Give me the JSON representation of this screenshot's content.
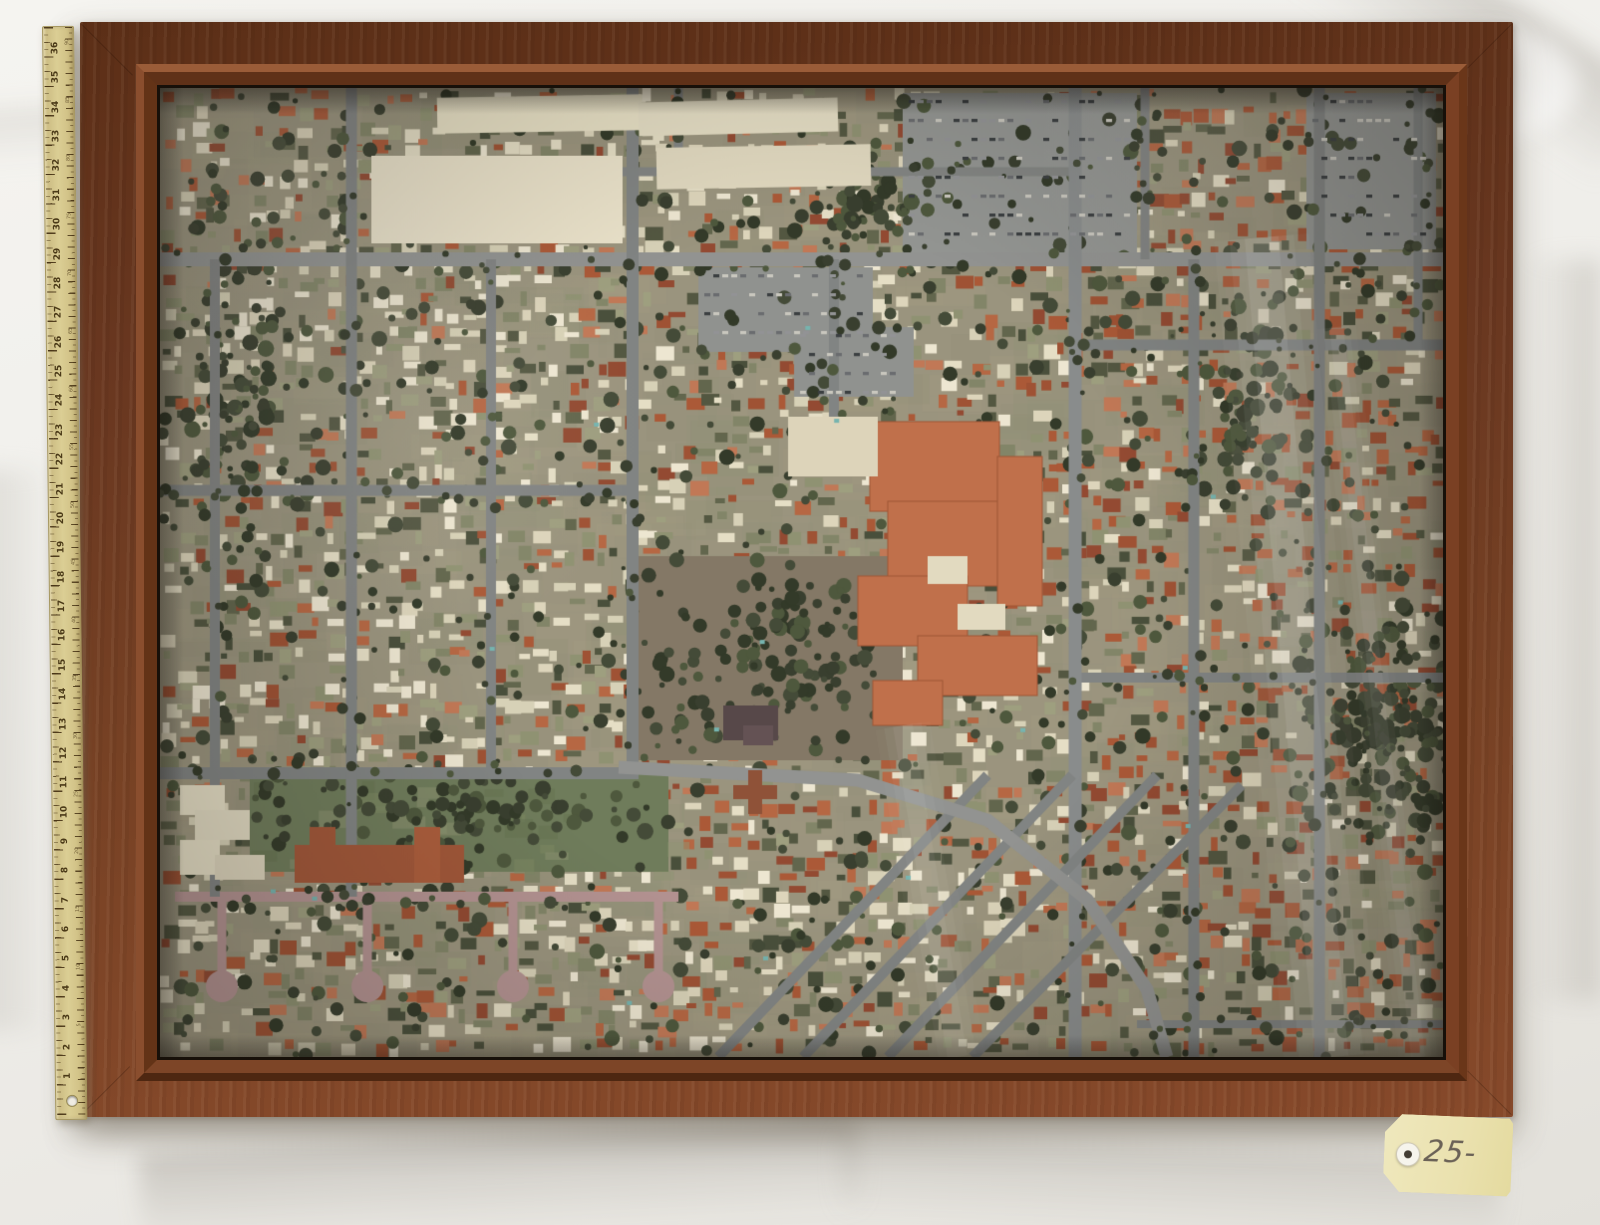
{
  "scene": {
    "tag": {
      "label": "25-234",
      "color": "#eae1ae"
    },
    "ruler": {
      "inch_numbers": [
        36,
        35,
        34,
        33,
        32,
        31,
        30,
        29,
        28,
        27,
        26,
        25,
        24,
        23,
        22,
        21,
        20,
        19,
        18,
        17,
        16,
        15,
        14,
        13,
        12,
        11,
        10,
        9,
        8,
        7,
        6,
        5,
        4,
        3,
        2,
        1
      ],
      "cm_numbers": [
        90,
        85,
        80,
        75,
        70,
        65,
        60,
        55,
        50,
        45,
        40,
        35,
        30,
        25,
        20,
        15,
        10,
        5
      ],
      "inch_spacing": 29.37,
      "cm_spacing": 11.56
    },
    "colors": {
      "cloth": "#f0efeb",
      "frame_dark": "#5c2f17",
      "frame_light": "#86492a",
      "ruler": "#d5c58b",
      "tag": "#eae1ae"
    }
  },
  "aerial": {
    "seed": 77,
    "width": 1287,
    "height": 973,
    "base": "#96917b",
    "mottle": [
      "#a29a80",
      "#8d8872",
      "#9b957e",
      "#878a70",
      "#a79f86"
    ],
    "palette": {
      "red": [
        "#a8512f",
        "#b4603c",
        "#8e4129",
        "#c07350",
        "#9b4a2c"
      ],
      "cream": [
        "#e7e0c8",
        "#ded7bd",
        "#efe9d4",
        "#d8d2b8"
      ],
      "olive": [
        "#8a8f6e",
        "#9a9c7c",
        "#7c8163"
      ],
      "dark": [
        "#4a4f3a",
        "#5a5f46",
        "#3f4633"
      ]
    },
    "regions": [
      {
        "x0": 915,
        "x1": 1287,
        "y0": 0,
        "y1": 973,
        "w": {
          "red": 0.46,
          "cream": 0.2,
          "olive": 0.14,
          "dark": 0.2
        }
      },
      {
        "x0": 0,
        "x1": 915,
        "y0": 0,
        "y1": 172,
        "w": {
          "cream": 0.38,
          "red": 0.28,
          "olive": 0.18,
          "dark": 0.16
        }
      },
      {
        "x0": 0,
        "x1": 480,
        "y0": 172,
        "y1": 973,
        "w": {
          "cream": 0.4,
          "red": 0.22,
          "olive": 0.22,
          "dark": 0.16
        }
      },
      {
        "x0": 480,
        "x1": 915,
        "y0": 172,
        "y1": 973,
        "w": {
          "red": 0.32,
          "cream": 0.3,
          "olive": 0.2,
          "dark": 0.18
        }
      }
    ],
    "road_minor": "#7b7f80",
    "road_major": "#8d9090",
    "roads_h": [
      {
        "y": 172,
        "x0": 0,
        "x1": 1287,
        "w": 14,
        "c": "#8d9090"
      },
      {
        "y": 84,
        "x0": 460,
        "x1": 920,
        "w": 9,
        "c": "#7d8180"
      },
      {
        "y": 404,
        "x0": 0,
        "x1": 480,
        "w": 11,
        "c": "#7b7f80"
      },
      {
        "y": 688,
        "x0": 0,
        "x1": 480,
        "w": 12,
        "c": "#7b7f80"
      },
      {
        "y": 258,
        "x0": 915,
        "x1": 1287,
        "w": 11,
        "c": "#7b7f80"
      },
      {
        "y": 592,
        "x0": 915,
        "x1": 1287,
        "w": 10,
        "c": "#7b7f80"
      },
      {
        "y": 812,
        "x0": 15,
        "x1": 520,
        "w": 10,
        "c": "#b18f90"
      },
      {
        "y": 940,
        "x0": 980,
        "x1": 1287,
        "w": 8,
        "c": "#7b7f80"
      }
    ],
    "roads_v": [
      {
        "x": 55,
        "y0": 172,
        "y1": 812,
        "w": 10,
        "c": "#7b7f80"
      },
      {
        "x": 192,
        "y0": 0,
        "y1": 812,
        "w": 11,
        "c": "#7b7f80"
      },
      {
        "x": 332,
        "y0": 172,
        "y1": 688,
        "w": 10,
        "c": "#7b7f80"
      },
      {
        "x": 474,
        "y0": 0,
        "y1": 688,
        "w": 12,
        "c": "#7b7f80"
      },
      {
        "x": 520,
        "y0": 0,
        "y1": 84,
        "w": 9,
        "c": "#7b7f80"
      },
      {
        "x": 676,
        "y0": 172,
        "y1": 345,
        "w": 10,
        "c": "#7b7f80"
      },
      {
        "x": 918,
        "y0": 0,
        "y1": 973,
        "w": 13,
        "c": "#84888a"
      },
      {
        "x": 988,
        "y0": 0,
        "y1": 172,
        "w": 9,
        "c": "#7b7f80"
      },
      {
        "x": 1037,
        "y0": 172,
        "y1": 973,
        "w": 11,
        "c": "#7b7f80"
      },
      {
        "x": 1163,
        "y0": 0,
        "y1": 973,
        "w": 11,
        "c": "#7b7f80"
      },
      {
        "x": 1262,
        "y0": 0,
        "y1": 258,
        "w": 9,
        "c": "#7b7f80"
      }
    ],
    "diagonals": [
      {
        "x0": 560,
        "y0": 973,
        "x1": 830,
        "y1": 690,
        "w": 10
      },
      {
        "x0": 645,
        "y0": 973,
        "x1": 915,
        "y1": 690,
        "w": 10
      },
      {
        "x0": 730,
        "y0": 973,
        "x1": 1000,
        "y1": 690,
        "w": 10
      },
      {
        "x0": 815,
        "y0": 973,
        "x1": 1085,
        "y1": 700,
        "w": 10
      }
    ],
    "curve": {
      "pts": [
        [
          460,
          682
        ],
        [
          700,
          695
        ],
        [
          830,
          735
        ],
        [
          930,
          815
        ],
        [
          990,
          905
        ],
        [
          1010,
          973
        ]
      ],
      "w": 13
    },
    "culdesac": {
      "c": "#b18f90",
      "stems": [
        62,
        208,
        354,
        500
      ],
      "y0": 812,
      "y1": 896
    },
    "patches": [
      {
        "x": 90,
        "y": 682,
        "w": 420,
        "h": 105,
        "c": "#687755",
        "t": "park"
      },
      {
        "x": 480,
        "y": 470,
        "w": 265,
        "h": 205,
        "c": "#7e7361",
        "t": "field"
      },
      {
        "x": 540,
        "y": 180,
        "w": 175,
        "h": 85,
        "c": "#8b8e8d",
        "t": "parking"
      },
      {
        "x": 745,
        "y": 5,
        "w": 235,
        "h": 162,
        "c": "#8f9291",
        "t": "parking"
      },
      {
        "x": 1150,
        "y": 5,
        "w": 130,
        "h": 157,
        "c": "#8f9291",
        "t": "parking"
      },
      {
        "x": 636,
        "y": 240,
        "w": 120,
        "h": 70,
        "c": "#8b8e8d",
        "t": "parking"
      }
    ],
    "park_tones": [
      "#77855f",
      "#5c6b4a",
      "#8a9270"
    ],
    "hospital": {
      "c": "#bf6a44",
      "edge": "#9c4f2e",
      "rects": [
        [
          712,
          335,
          130,
          90
        ],
        [
          730,
          415,
          150,
          85
        ],
        [
          700,
          490,
          110,
          70
        ],
        [
          760,
          550,
          120,
          60
        ],
        [
          715,
          595,
          70,
          45
        ],
        [
          840,
          370,
          45,
          150
        ]
      ],
      "white": [
        [
          770,
          470,
          40,
          28
        ],
        [
          800,
          518,
          48,
          26
        ]
      ]
    },
    "buildings": [
      {
        "x": 278,
        "y": 8,
        "w": 205,
        "h": 36,
        "c": "#e9e2c8",
        "rot": -1
      },
      {
        "x": 212,
        "y": 68,
        "w": 252,
        "h": 88,
        "c": "#ece5cd",
        "rot": 0
      },
      {
        "x": 480,
        "y": 12,
        "w": 200,
        "h": 34,
        "c": "#e6dfc6",
        "rot": -1.5
      },
      {
        "x": 498,
        "y": 58,
        "w": 215,
        "h": 42,
        "c": "#e2dbc2",
        "rot": -1
      },
      {
        "x": 630,
        "y": 330,
        "w": 90,
        "h": 60,
        "c": "#ded6bc",
        "rot": 0
      },
      {
        "x": 20,
        "y": 700,
        "w": 45,
        "h": 30,
        "c": "#e8e1c9",
        "rot": 0
      },
      {
        "x": 35,
        "y": 725,
        "w": 55,
        "h": 30,
        "c": "#e4ddc5",
        "rot": 0
      },
      {
        "x": 20,
        "y": 755,
        "w": 40,
        "h": 35,
        "c": "#e8e1c9",
        "rot": 0
      },
      {
        "x": 55,
        "y": 770,
        "w": 50,
        "h": 25,
        "c": "#ded7bf",
        "rot": 0
      },
      {
        "x": 135,
        "y": 760,
        "w": 170,
        "h": 38,
        "c": "#9e4f31",
        "rot": 0
      },
      {
        "x": 150,
        "y": 742,
        "w": 26,
        "h": 56,
        "c": "#9e4f31",
        "rot": 0
      },
      {
        "x": 255,
        "y": 742,
        "w": 26,
        "h": 56,
        "c": "#a85634",
        "rot": 0
      },
      {
        "x": 575,
        "y": 700,
        "w": 44,
        "h": 14,
        "c": "#8a4a30",
        "rot": 0
      },
      {
        "x": 590,
        "y": 685,
        "w": 14,
        "h": 44,
        "c": "#8a4a30",
        "rot": 0
      },
      {
        "x": 565,
        "y": 620,
        "w": 55,
        "h": 35,
        "c": "#4e3f42",
        "rot": 0
      },
      {
        "x": 585,
        "y": 640,
        "w": 30,
        "h": 20,
        "c": "#5c4a4e",
        "rot": 0
      }
    ],
    "car_tones": [
      "#30353a",
      "#c9c8c0",
      "#62666b",
      "#8d9094"
    ],
    "pools": 16,
    "pool_tone": "#6fb3b0",
    "trees_base": 900,
    "tree_tones": [
      "#2e3526",
      "#3a4230",
      "#273020",
      "#445035"
    ],
    "tree_clusters": [
      {
        "x": 1240,
        "y": 640,
        "rx": 110,
        "ry": 130,
        "n": 220
      },
      {
        "x": 610,
        "y": 570,
        "rx": 130,
        "ry": 100,
        "n": 110
      },
      {
        "x": 300,
        "y": 732,
        "rx": 200,
        "ry": 55,
        "n": 90
      },
      {
        "x": 700,
        "y": 120,
        "rx": 90,
        "ry": 60,
        "n": 60
      },
      {
        "x": 70,
        "y": 300,
        "rx": 60,
        "ry": 200,
        "n": 80
      },
      {
        "x": 1100,
        "y": 300,
        "rx": 60,
        "ry": 150,
        "n": 70
      }
    ],
    "street_trees": 320,
    "reflections": [
      {
        "x0": 1105,
        "y0": 150,
        "x1": 1175,
        "y1": 973,
        "w": 34,
        "a": 0.1
      },
      {
        "x0": 1180,
        "y0": 240,
        "x1": 1262,
        "y1": 973,
        "w": 14,
        "a": 0.07
      },
      {
        "x0": 745,
        "y0": 640,
        "x1": 800,
        "y1": 973,
        "w": 20,
        "a": 0.06
      }
    ],
    "glare": [
      {
        "x": 240,
        "y": 330,
        "r": 260,
        "a": 0.07
      },
      {
        "x": 120,
        "y": 90,
        "r": 200,
        "a": 0.06
      },
      {
        "x": 1050,
        "y": 60,
        "r": 180,
        "a": 0.05
      }
    ],
    "haze": "rgba(212,198,176,0.07)"
  }
}
